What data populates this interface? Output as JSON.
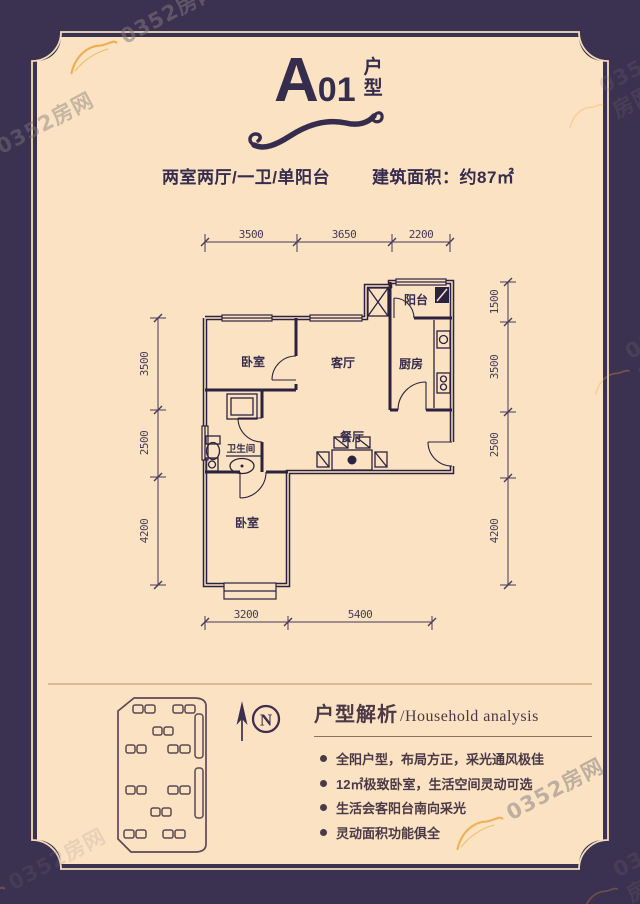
{
  "brand": {
    "watermark": "0352房网"
  },
  "title": {
    "letter": "A",
    "number": "01",
    "type_char1": "户",
    "type_char2": "型"
  },
  "subtitle": {
    "layout": "两室两厅/一卫/单阳台",
    "area_label": "建筑面积：约87㎡"
  },
  "floorplan": {
    "labels": {
      "bedroom_top": "卧室",
      "living": "客厅",
      "kitchen": "厨房",
      "balcony": "阳台",
      "bathroom": "卫生间",
      "dining": "餐厅",
      "bedroom_bottom": "卧室"
    },
    "dimensions": {
      "top": [
        "3500",
        "3650",
        "2200"
      ],
      "left": [
        "3500",
        "2500",
        "4200"
      ],
      "right": [
        "1500",
        "3500",
        "2500",
        "4200"
      ],
      "bottom": [
        "3200",
        "5400"
      ]
    }
  },
  "compass": {
    "label": "N"
  },
  "analysis": {
    "title_zh": "户型解析",
    "title_en": "/Household analysis",
    "bullets": [
      "全阳户型，布局方正，采光通风极佳",
      "12㎡极致卧室，生活空间灵动可选",
      "生活会客阳台南向采光",
      "灵动面积功能俱全"
    ]
  },
  "colors": {
    "frame_purple": "#3b3150",
    "panel_cream": "#fbe2c2",
    "ink": "#362c4e",
    "analysis_ink": "#4b3947",
    "watermark_orange": "#eda73e",
    "divider_brown": "#c79f7a"
  }
}
